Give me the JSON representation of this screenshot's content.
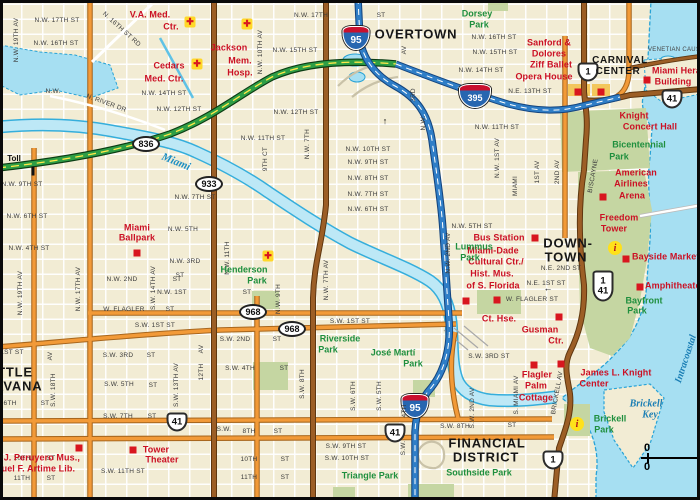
{
  "map": {
    "title_hint": "Downtown Miami street map",
    "colors": {
      "land": "#F2ECD4",
      "water": "#A6DFF2",
      "shoreline": "#29A3D6",
      "park": "#C5D6A2",
      "orange_road": "#F29A38",
      "brown_road": "#9C5E26",
      "toll_green": "#2E9E45",
      "interstate_blue": "#2F7EC7",
      "poi_red": "#D8161F",
      "landmark_red": "#CB1024",
      "park_text": "#1F8F3E",
      "water_text": "#1B7FB5"
    },
    "scale": {
      "top": "0",
      "bottom": "0"
    },
    "labels": [
      {
        "t": "N.W. 17TH ST",
        "x": 57,
        "y": 21
      },
      {
        "t": "N.W. 16TH ST",
        "x": 56,
        "y": 44
      },
      {
        "t": "N. 16TH ST RD",
        "x": 121,
        "y": 30,
        "r": 42
      },
      {
        "t": "N.W. 19TH AV",
        "x": 17,
        "y": 40,
        "r": -90
      },
      {
        "t": "N.W.",
        "x": 53,
        "y": 92
      },
      {
        "t": "N. RIVER DR",
        "x": 106,
        "y": 104,
        "r": 20
      },
      {
        "t": "N.W. 14TH ST",
        "x": 164,
        "y": 94
      },
      {
        "t": "N.W. 12TH ST",
        "x": 179,
        "y": 110
      },
      {
        "t": "N.W. 10TH AV",
        "x": 261,
        "y": 52,
        "r": -90
      },
      {
        "t": "N.W. 15TH ST",
        "x": 295,
        "y": 51
      },
      {
        "t": "N.W. 17TH",
        "x": 311,
        "y": 16
      },
      {
        "t": "ST",
        "x": 381,
        "y": 16
      },
      {
        "t": "N.W. 12TH ST",
        "x": 296,
        "y": 113
      },
      {
        "t": "N.W. 11TH ST",
        "x": 263,
        "y": 139
      },
      {
        "t": "9TH CT",
        "x": 266,
        "y": 159,
        "r": -90
      },
      {
        "t": "N.W. 7TH",
        "x": 308,
        "y": 144,
        "r": -90
      },
      {
        "t": "AV",
        "x": 405,
        "y": 50,
        "r": -90
      },
      {
        "t": "3RD",
        "x": 414,
        "y": 95,
        "r": -90
      },
      {
        "t": "N.W.",
        "x": 424,
        "y": 123,
        "r": -90
      },
      {
        "t": "N.W. 10TH ST",
        "x": 368,
        "y": 150
      },
      {
        "t": "N.W. 9TH ST",
        "x": 368,
        "y": 163
      },
      {
        "t": "N.W. 8TH ST",
        "x": 368,
        "y": 179
      },
      {
        "t": "N.W. 7TH ST",
        "x": 368,
        "y": 195
      },
      {
        "t": "N.W. 6TH ST",
        "x": 368,
        "y": 210
      },
      {
        "t": "N.W. 5TH ST",
        "x": 472,
        "y": 227
      },
      {
        "t": "N.W. 16TH ST",
        "x": 494,
        "y": 38
      },
      {
        "t": "N.W. 15TH ST",
        "x": 495,
        "y": 53
      },
      {
        "t": "N.W. 14TH ST",
        "x": 481,
        "y": 71
      },
      {
        "t": "N.E. 13TH ST",
        "x": 530,
        "y": 92
      },
      {
        "t": "N.W. 11TH ST",
        "x": 497,
        "y": 128
      },
      {
        "t": "N.W. 9TH ST",
        "x": 22,
        "y": 185
      },
      {
        "t": "N.W. 7TH ST",
        "x": 195,
        "y": 198
      },
      {
        "t": "N.W. 6TH ST",
        "x": 27,
        "y": 217
      },
      {
        "t": "N.W. 5TH",
        "x": 183,
        "y": 230
      },
      {
        "t": "N.W. 4TH ST",
        "x": 29,
        "y": 249
      },
      {
        "t": "N.W. 3RD",
        "x": 185,
        "y": 262
      },
      {
        "t": "ST",
        "x": 180,
        "y": 276
      },
      {
        "t": "N.W. 2ND",
        "x": 122,
        "y": 280
      },
      {
        "t": "ST",
        "x": 177,
        "y": 280
      },
      {
        "t": "N.W. 1ST",
        "x": 172,
        "y": 293
      },
      {
        "t": "ST",
        "x": 247,
        "y": 293
      },
      {
        "t": "W. FLAGLER",
        "x": 124,
        "y": 310
      },
      {
        "t": "ST",
        "x": 170,
        "y": 310
      },
      {
        "t": "S.W. 1ST ST",
        "x": 155,
        "y": 326
      },
      {
        "t": "S.W. 1ST ST",
        "x": 350,
        "y": 322
      },
      {
        "t": "N.W. 19TH AV",
        "x": 21,
        "y": 293,
        "r": -90
      },
      {
        "t": "N.W. 17TH AV",
        "x": 79,
        "y": 289,
        "r": -90
      },
      {
        "t": "S.W. 14TH AV",
        "x": 154,
        "y": 288,
        "r": -90
      },
      {
        "t": "N.W. 11TH",
        "x": 228,
        "y": 258,
        "r": -90
      },
      {
        "t": "N.W. 9TH",
        "x": 279,
        "y": 299,
        "r": -90
      },
      {
        "t": "N.W. 7TH AV",
        "x": 327,
        "y": 280,
        "r": -90
      },
      {
        "t": "S.W. 2ND",
        "x": 235,
        "y": 340
      },
      {
        "t": "ST",
        "x": 277,
        "y": 340
      },
      {
        "t": "S.W. 4TH",
        "x": 240,
        "y": 369
      },
      {
        "t": "ST",
        "x": 284,
        "y": 369
      },
      {
        "t": "1ST ST",
        "x": 12,
        "y": 353
      },
      {
        "t": "S.W. 3RD",
        "x": 118,
        "y": 356
      },
      {
        "t": "ST",
        "x": 151,
        "y": 356
      },
      {
        "t": "S.W. 5TH",
        "x": 119,
        "y": 385
      },
      {
        "t": "ST",
        "x": 153,
        "y": 386
      },
      {
        "t": "6TH",
        "x": 10,
        "y": 404
      },
      {
        "t": "ST",
        "x": 45,
        "y": 404
      },
      {
        "t": "S.W. 7TH",
        "x": 118,
        "y": 417
      },
      {
        "t": "ST",
        "x": 152,
        "y": 417
      },
      {
        "t": "S.W.",
        "x": 224,
        "y": 430
      },
      {
        "t": "8TH",
        "x": 249,
        "y": 432
      },
      {
        "t": "ST",
        "x": 278,
        "y": 432
      },
      {
        "t": "S.W. 13TH AV",
        "x": 177,
        "y": 385,
        "r": -90
      },
      {
        "t": "AV",
        "x": 202,
        "y": 349,
        "r": -90
      },
      {
        "t": "12TH",
        "x": 202,
        "y": 372,
        "r": -90
      },
      {
        "t": "S.W. 18TH",
        "x": 54,
        "y": 390,
        "r": -90
      },
      {
        "t": "AV",
        "x": 51,
        "y": 356,
        "r": -90
      },
      {
        "t": "S.W. 8TH",
        "x": 303,
        "y": 384,
        "r": -90
      },
      {
        "t": "S.W. 6TH",
        "x": 354,
        "y": 396,
        "r": -90
      },
      {
        "t": "S.W. 5TH",
        "x": 380,
        "y": 396,
        "r": -90
      },
      {
        "t": "4TH",
        "x": 405,
        "y": 411,
        "r": -90
      },
      {
        "t": "S.W.",
        "x": 404,
        "y": 448,
        "r": -90
      },
      {
        "t": "S.W. 9TH ST",
        "x": 346,
        "y": 447
      },
      {
        "t": "S.W. 10TH ST",
        "x": 347,
        "y": 459
      },
      {
        "t": "10TH",
        "x": 22,
        "y": 459
      },
      {
        "t": "ST",
        "x": 51,
        "y": 459
      },
      {
        "t": "11TH",
        "x": 22,
        "y": 479
      },
      {
        "t": "ST",
        "x": 51,
        "y": 479
      },
      {
        "t": "10TH",
        "x": 249,
        "y": 460
      },
      {
        "t": "ST",
        "x": 285,
        "y": 460
      },
      {
        "t": "11TH",
        "x": 249,
        "y": 478
      },
      {
        "t": "ST",
        "x": 285,
        "y": 478
      },
      {
        "t": "S.W. 11TH ST",
        "x": 123,
        "y": 472
      },
      {
        "t": "S.W. 8TH",
        "x": 455,
        "y": 427
      },
      {
        "t": "ST",
        "x": 512,
        "y": 426
      },
      {
        "t": "S.W. 3RD ST",
        "x": 489,
        "y": 357
      },
      {
        "t": "N.E. 2ND ST",
        "x": 561,
        "y": 269
      },
      {
        "t": "N.E. 1ST ST",
        "x": 546,
        "y": 284
      },
      {
        "t": "W. FLAGLER ST",
        "x": 532,
        "y": 300
      },
      {
        "t": "N.W. 1ST AV",
        "x": 498,
        "y": 158,
        "r": -90
      },
      {
        "t": "MIAMI",
        "x": 516,
        "y": 186,
        "r": -90
      },
      {
        "t": "1ST AV",
        "x": 538,
        "y": 172,
        "r": -90
      },
      {
        "t": "2ND AV",
        "x": 558,
        "y": 172,
        "r": -90
      },
      {
        "t": "BISCAYNE",
        "x": 594,
        "y": 176,
        "r": -80
      },
      {
        "t": "N.W. 2ND AV",
        "x": 449,
        "y": 253,
        "r": -90
      },
      {
        "t": "S.W. 2ND AV",
        "x": 473,
        "y": 408,
        "r": -90
      },
      {
        "t": "S. MIAMI AV",
        "x": 517,
        "y": 395,
        "r": -90
      },
      {
        "t": "BRICKELL AV",
        "x": 558,
        "y": 393,
        "r": -80
      },
      {
        "t": "OVERTOWN",
        "x": 416,
        "y": 34,
        "c": "city"
      },
      {
        "t": "DOWN-",
        "x": 568,
        "y": 243,
        "c": "city"
      },
      {
        "t": "TOWN",
        "x": 566,
        "y": 257,
        "c": "city"
      },
      {
        "t": "LITTLE",
        "x": -16,
        "y": 372,
        "c": "city",
        "a": "l"
      },
      {
        "t": "HAVANA",
        "x": -16,
        "y": 386,
        "c": "city",
        "a": "l"
      },
      {
        "t": "CARNIVAL",
        "x": 620,
        "y": 61,
        "c": "city2"
      },
      {
        "t": "CENTER",
        "x": 618,
        "y": 72,
        "c": "city2"
      },
      {
        "t": "FINANCIAL",
        "x": 487,
        "y": 443,
        "c": "city"
      },
      {
        "t": "DISTRICT",
        "x": 486,
        "y": 457,
        "c": "city"
      },
      {
        "t": "Toll",
        "x": 14,
        "y": 159,
        "c": "toll"
      },
      {
        "t": "V.A. Med.",
        "x": 150,
        "y": 15,
        "c": "red"
      },
      {
        "t": "Ctr.",
        "x": 171,
        "y": 27,
        "c": "red"
      },
      {
        "t": "Cedars",
        "x": 169,
        "y": 66,
        "c": "red"
      },
      {
        "t": "Med. Ctr.",
        "x": 164,
        "y": 79,
        "c": "red"
      },
      {
        "t": "Jackson",
        "x": 229,
        "y": 48,
        "c": "red"
      },
      {
        "t": "Mem.",
        "x": 240,
        "y": 61,
        "c": "red"
      },
      {
        "t": "Hosp.",
        "x": 240,
        "y": 73,
        "c": "red"
      },
      {
        "t": "Sanford &",
        "x": 549,
        "y": 43,
        "c": "red"
      },
      {
        "t": "Dolores",
        "x": 549,
        "y": 54,
        "c": "red"
      },
      {
        "t": "Ziff Ballet",
        "x": 551,
        "y": 65,
        "c": "red"
      },
      {
        "t": "Opera House",
        "x": 544,
        "y": 77,
        "c": "red"
      },
      {
        "t": "Miami Herald",
        "x": 652,
        "y": 71,
        "c": "red",
        "a": "l"
      },
      {
        "t": "Building",
        "x": 673,
        "y": 82,
        "c": "red"
      },
      {
        "t": "Knight",
        "x": 634,
        "y": 116,
        "c": "red"
      },
      {
        "t": "Concert Hall",
        "x": 650,
        "y": 127,
        "c": "red"
      },
      {
        "t": "American",
        "x": 636,
        "y": 173,
        "c": "red"
      },
      {
        "t": "Airlines",
        "x": 631,
        "y": 184,
        "c": "red"
      },
      {
        "t": "Arena",
        "x": 632,
        "y": 196,
        "c": "red"
      },
      {
        "t": "Freedom",
        "x": 619,
        "y": 218,
        "c": "red"
      },
      {
        "t": "Tower",
        "x": 614,
        "y": 229,
        "c": "red"
      },
      {
        "t": "Bayside Marketplace",
        "x": 632,
        "y": 257,
        "c": "red",
        "a": "l"
      },
      {
        "t": "Amphitheater",
        "x": 645,
        "y": 286,
        "c": "red",
        "a": "l"
      },
      {
        "t": "Bus Station",
        "x": 499,
        "y": 238,
        "c": "red"
      },
      {
        "t": "Miami-Dade",
        "x": 493,
        "y": 251,
        "c": "red"
      },
      {
        "t": "Cultural Ctr./",
        "x": 496,
        "y": 262,
        "c": "red"
      },
      {
        "t": "Hist. Mus.",
        "x": 492,
        "y": 274,
        "c": "red"
      },
      {
        "t": "of S. Florida",
        "x": 493,
        "y": 286,
        "c": "red"
      },
      {
        "t": "Ct. Hse.",
        "x": 499,
        "y": 319,
        "c": "red"
      },
      {
        "t": "Gusman",
        "x": 540,
        "y": 330,
        "c": "red"
      },
      {
        "t": "Ctr.",
        "x": 556,
        "y": 341,
        "c": "red"
      },
      {
        "t": "Miami",
        "x": 137,
        "y": 228,
        "c": "red"
      },
      {
        "t": "Ballpark",
        "x": 137,
        "y": 238,
        "c": "red"
      },
      {
        "t": "Flagler",
        "x": 537,
        "y": 375,
        "c": "red"
      },
      {
        "t": "Palm",
        "x": 536,
        "y": 386,
        "c": "red"
      },
      {
        "t": "Cottage",
        "x": 536,
        "y": 398,
        "c": "red"
      },
      {
        "t": "James L. Knight",
        "x": 616,
        "y": 373,
        "c": "red"
      },
      {
        "t": "Center",
        "x": 594,
        "y": 384,
        "c": "red"
      },
      {
        "t": "Tower",
        "x": 156,
        "y": 450,
        "c": "red"
      },
      {
        "t": "Theater",
        "x": 162,
        "y": 460,
        "c": "red"
      },
      {
        "t": "a J. Peruyero Mus.,",
        "x": -4,
        "y": 458,
        "c": "red",
        "a": "l"
      },
      {
        "t": "nuel F. Artime Lib.",
        "x": -4,
        "y": 469,
        "c": "red",
        "a": "l"
      },
      {
        "t": "Dorsey",
        "x": 477,
        "y": 14,
        "c": "park"
      },
      {
        "t": "Park",
        "x": 479,
        "y": 25,
        "c": "park"
      },
      {
        "t": "Lummus",
        "x": 474,
        "y": 247,
        "c": "park"
      },
      {
        "t": "Park",
        "x": 470,
        "y": 258,
        "c": "park"
      },
      {
        "t": "Henderson",
        "x": 244,
        "y": 270,
        "c": "park"
      },
      {
        "t": "Park",
        "x": 257,
        "y": 281,
        "c": "park"
      },
      {
        "t": "Bicentennial",
        "x": 639,
        "y": 145,
        "c": "park"
      },
      {
        "t": "Park",
        "x": 619,
        "y": 157,
        "c": "park"
      },
      {
        "t": "Bayfront",
        "x": 644,
        "y": 301,
        "c": "park"
      },
      {
        "t": "Park",
        "x": 637,
        "y": 311,
        "c": "park"
      },
      {
        "t": "Riverside",
        "x": 340,
        "y": 339,
        "c": "park"
      },
      {
        "t": "Park",
        "x": 328,
        "y": 350,
        "c": "park"
      },
      {
        "t": "José Martí",
        "x": 393,
        "y": 353,
        "c": "park"
      },
      {
        "t": "Park",
        "x": 413,
        "y": 364,
        "c": "park"
      },
      {
        "t": "Triangle Park",
        "x": 370,
        "y": 476,
        "c": "park"
      },
      {
        "t": "Southside Park",
        "x": 479,
        "y": 473,
        "c": "park"
      },
      {
        "t": "Brickell",
        "x": 610,
        "y": 419,
        "c": "park"
      },
      {
        "t": "Park",
        "x": 604,
        "y": 430,
        "c": "park"
      },
      {
        "t": "Miami",
        "x": 176,
        "y": 162,
        "c": "wat",
        "r": 22
      },
      {
        "t": "Brickell",
        "x": 646,
        "y": 404,
        "c": "wat2"
      },
      {
        "t": "Key",
        "x": 650,
        "y": 415,
        "c": "wat2"
      },
      {
        "t": "Intracoastal",
        "x": 686,
        "y": 359,
        "c": "wat2",
        "r": -72
      },
      {
        "t": "VENETIAN CAUSEWAY",
        "x": 648,
        "y": 50,
        "c": "ven",
        "a": "l"
      },
      {
        "t": "↑",
        "x": 385,
        "y": 121,
        "c": "arw"
      },
      {
        "t": "←",
        "x": 548,
        "y": 288,
        "c": "arw"
      }
    ],
    "shields": [
      {
        "n": "i95-shield-north",
        "type": "i",
        "t": "95",
        "x": 356,
        "y": 38
      },
      {
        "n": "i395-shield",
        "type": "i wide",
        "t": "395",
        "x": 475,
        "y": 96,
        "w": 32
      },
      {
        "n": "i95-shield-south",
        "type": "i",
        "t": "95",
        "x": 415,
        "y": 406
      },
      {
        "n": "us1-shield-north",
        "type": "us",
        "t": "1",
        "x": 588,
        "y": 72
      },
      {
        "n": "us41-shield-causeway",
        "type": "us",
        "t": "41",
        "x": 672,
        "y": 99
      },
      {
        "n": "us1-us41-shield-downtown",
        "type": "us2",
        "l1": "1",
        "l2": "41",
        "x": 603,
        "y": 286
      },
      {
        "n": "us41-shield-sw7th",
        "type": "us",
        "t": "41",
        "x": 177,
        "y": 422
      },
      {
        "n": "us41-shield-sw8th",
        "type": "us",
        "t": "41",
        "x": 395,
        "y": 433
      },
      {
        "n": "us1-shield-brickell",
        "type": "us",
        "t": "1",
        "x": 553,
        "y": 460
      },
      {
        "n": "sr836-shield",
        "type": "oval",
        "t": "836",
        "x": 146,
        "y": 144
      },
      {
        "n": "sr933-shield",
        "type": "oval",
        "t": "933",
        "x": 209,
        "y": 184
      },
      {
        "n": "sr968-shield-flagler",
        "type": "oval",
        "t": "968",
        "x": 253,
        "y": 312
      },
      {
        "n": "sr968-shield-sw1st",
        "type": "oval",
        "t": "968",
        "x": 292,
        "y": 329
      }
    ],
    "pois": [
      {
        "k": "cross",
        "x": 190,
        "y": 22
      },
      {
        "k": "cross",
        "x": 247,
        "y": 24
      },
      {
        "k": "cross",
        "x": 197,
        "y": 64
      },
      {
        "k": "cross",
        "x": 268,
        "y": 256
      },
      {
        "k": "square",
        "x": 137,
        "y": 253
      },
      {
        "k": "square",
        "x": 535,
        "y": 238
      },
      {
        "k": "square",
        "x": 466,
        "y": 301
      },
      {
        "k": "square",
        "x": 497,
        "y": 300
      },
      {
        "k": "square",
        "x": 559,
        "y": 317
      },
      {
        "k": "square",
        "x": 603,
        "y": 197
      },
      {
        "k": "square",
        "x": 626,
        "y": 259
      },
      {
        "k": "square",
        "x": 640,
        "y": 287
      },
      {
        "k": "square",
        "x": 647,
        "y": 80
      },
      {
        "k": "square",
        "x": 578,
        "y": 92
      },
      {
        "k": "square",
        "x": 601,
        "y": 92
      },
      {
        "k": "square",
        "x": 534,
        "y": 365
      },
      {
        "k": "square",
        "x": 561,
        "y": 364
      },
      {
        "k": "square",
        "x": 133,
        "y": 450
      },
      {
        "k": "square",
        "x": 79,
        "y": 448
      },
      {
        "k": "info",
        "x": 615,
        "y": 248
      },
      {
        "k": "info",
        "x": 577,
        "y": 424
      },
      {
        "k": "tick",
        "x": 33,
        "y": 171
      }
    ]
  }
}
